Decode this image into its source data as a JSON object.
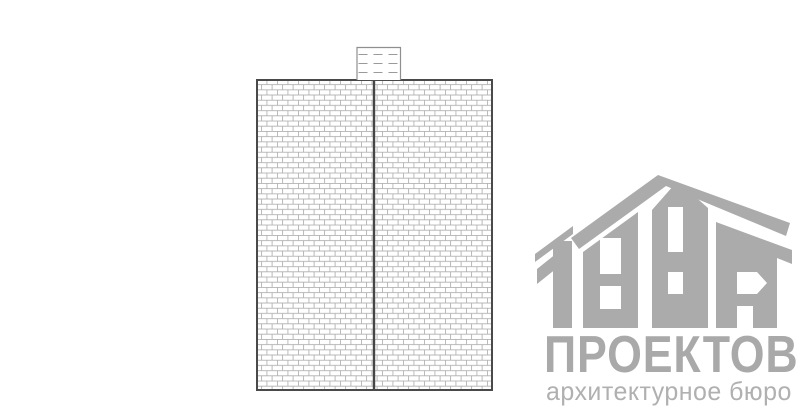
{
  "canvas": {
    "width": 800,
    "height": 418,
    "background": "#ffffff"
  },
  "drawing": {
    "type": "brick wall elevation with chimney",
    "wall": {
      "x": 256,
      "y": 79,
      "width": 237,
      "height": 312,
      "halves": 2,
      "center_divider_x": 374,
      "hatch": "brick-running-bond",
      "brick_width": 10.5,
      "brick_height": 5.2,
      "hatch_line_color": "#b0b0b0",
      "outline_color": "#4a4a4a"
    },
    "chimney": {
      "x": 356,
      "y": 47,
      "width": 44,
      "height": 32,
      "dashed_course_lines": 3,
      "line_color": "#8f8f8f"
    }
  },
  "logo": {
    "digits": "1000",
    "name": "ПРОЕКТОВ",
    "tagline": "архитектурное бюро",
    "house_color": "#ababab",
    "name_color": "#a9a9a9",
    "tagline_color": "#b0b0b0"
  }
}
